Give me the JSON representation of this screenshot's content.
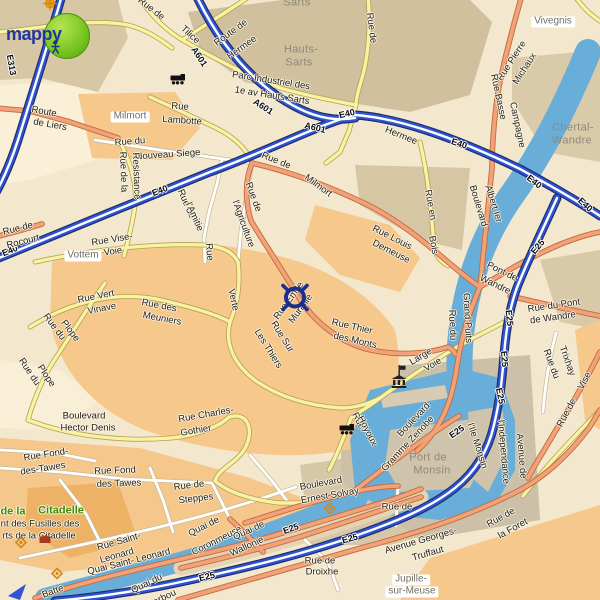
{
  "branding": {
    "logo_text": "mappy"
  },
  "marker": {
    "x": 295,
    "y": 300
  },
  "colors": {
    "water": "#68aed8",
    "highway_blue": "#2f55d4",
    "road_orange": "#f2a277",
    "road_yellow": "#f8f2a3",
    "residential_orange": "#f6c88c",
    "industrial_tan": "#d0c09e",
    "logo_green": "#76c51f",
    "logo_text_blue": "#23379b",
    "park_text_green": "#3f8c00"
  },
  "labels": [
    {
      "t": "E313",
      "x": 11,
      "y": 65,
      "r": 80,
      "c": "hwy"
    },
    {
      "t": "E40",
      "x": 10,
      "y": 251,
      "r": -22,
      "c": "hwy"
    },
    {
      "t": "E40",
      "x": 160,
      "y": 191,
      "r": -21,
      "c": "hwy"
    },
    {
      "t": "E40",
      "x": 347,
      "y": 114,
      "r": -13,
      "c": "hwy"
    },
    {
      "t": "A601",
      "x": 199,
      "y": 57,
      "r": 57,
      "c": "hwy"
    },
    {
      "t": "A601",
      "x": 263,
      "y": 107,
      "r": 33,
      "c": "hwy"
    },
    {
      "t": "A601",
      "x": 315,
      "y": 128,
      "r": 14,
      "c": "hwy"
    },
    {
      "t": "E40",
      "x": 459,
      "y": 144,
      "r": 18,
      "c": "hwy"
    },
    {
      "t": "E40",
      "x": 534,
      "y": 182,
      "r": 38,
      "c": "hwy"
    },
    {
      "t": "E40",
      "x": 585,
      "y": 205,
      "r": 43,
      "c": "hwy"
    },
    {
      "t": "E25",
      "x": 538,
      "y": 247,
      "r": -50,
      "c": "hwy"
    },
    {
      "t": "E25",
      "x": 509,
      "y": 318,
      "r": 84,
      "c": "hwy"
    },
    {
      "t": "E25",
      "x": 504,
      "y": 359,
      "r": 86,
      "c": "hwy"
    },
    {
      "t": "E25",
      "x": 500,
      "y": 396,
      "r": 78,
      "c": "hwy"
    },
    {
      "t": "E25",
      "x": 457,
      "y": 432,
      "r": -35,
      "c": "hwy"
    },
    {
      "t": "E25",
      "x": 291,
      "y": 529,
      "r": -20,
      "c": "hwy"
    },
    {
      "t": "E25",
      "x": 350,
      "y": 539,
      "r": -15,
      "c": "hwy"
    },
    {
      "t": "E25",
      "x": 207,
      "y": 577,
      "r": -13,
      "c": "hwy"
    },
    {
      "t": "Hermee",
      "x": 401,
      "y": 136,
      "r": 22,
      "c": "road"
    },
    {
      "t": "Rue de",
      "x": 151,
      "y": 9,
      "r": 38,
      "c": "road"
    },
    {
      "t": "Tilice",
      "x": 190,
      "y": 35,
      "r": 43,
      "c": "road"
    },
    {
      "t": "Route de",
      "x": 231,
      "y": 33,
      "r": -36,
      "c": "road"
    },
    {
      "t": "Hermee",
      "x": 242,
      "y": 48,
      "r": -36,
      "c": "road"
    },
    {
      "t": "Rue de",
      "x": 371,
      "y": 28,
      "r": 82,
      "c": "road"
    },
    {
      "t": "Parc Industriel des",
      "x": 271,
      "y": 81,
      "r": 9,
      "c": "road"
    },
    {
      "t": "1e av Hauts Sarts",
      "x": 272,
      "y": 96,
      "r": 9,
      "c": "road"
    },
    {
      "t": "Route",
      "x": 44,
      "y": 112,
      "r": 10,
      "c": "road"
    },
    {
      "t": "de Liers",
      "x": 50,
      "y": 125,
      "r": 10,
      "c": "road"
    },
    {
      "t": "Rue",
      "x": 180,
      "y": 107,
      "r": 4,
      "c": "road"
    },
    {
      "t": "Lambotte",
      "x": 182,
      "y": 121,
      "r": 4,
      "c": "road"
    },
    {
      "t": "Rue Pierre",
      "x": 512,
      "y": 61,
      "r": -57,
      "c": "road"
    },
    {
      "t": "Michaux",
      "x": 525,
      "y": 69,
      "r": -57,
      "c": "road"
    },
    {
      "t": "Rue Basse",
      "x": 498,
      "y": 97,
      "r": 78,
      "c": "road"
    },
    {
      "t": "Campagne",
      "x": 517,
      "y": 125,
      "r": 78,
      "c": "road"
    },
    {
      "t": "Rue du",
      "x": 130,
      "y": 142,
      "r": -4,
      "c": "road"
    },
    {
      "t": "Nouveau Siege",
      "x": 168,
      "y": 155,
      "r": -4,
      "c": "road"
    },
    {
      "t": "Rue de la",
      "x": 123,
      "y": 172,
      "r": 88,
      "c": "road"
    },
    {
      "t": "Resistance",
      "x": 136,
      "y": 176,
      "r": 88,
      "c": "road"
    },
    {
      "t": "Rue de",
      "x": 18,
      "y": 229,
      "r": -14,
      "c": "road"
    },
    {
      "t": "Rocourt",
      "x": 23,
      "y": 242,
      "r": -14,
      "c": "road"
    },
    {
      "t": "Rue Vise-",
      "x": 112,
      "y": 240,
      "r": -9,
      "c": "road"
    },
    {
      "t": "Voie",
      "x": 113,
      "y": 252,
      "r": -9,
      "c": "road"
    },
    {
      "t": "Rue de",
      "x": 186,
      "y": 204,
      "r": 66,
      "c": "road"
    },
    {
      "t": "l'Amitie",
      "x": 194,
      "y": 217,
      "r": 66,
      "c": "road"
    },
    {
      "t": "Rue de",
      "x": 253,
      "y": 197,
      "r": 70,
      "c": "road"
    },
    {
      "t": "l'Agriculture",
      "x": 243,
      "y": 224,
      "r": 70,
      "c": "road"
    },
    {
      "t": "Rue de",
      "x": 276,
      "y": 161,
      "r": 22,
      "c": "road"
    },
    {
      "t": "Milmort",
      "x": 318,
      "y": 186,
      "r": 36,
      "c": "road"
    },
    {
      "t": "Rue Louis",
      "x": 392,
      "y": 238,
      "r": 27,
      "c": "road"
    },
    {
      "t": "Demeuse",
      "x": 391,
      "y": 252,
      "r": 27,
      "c": "road"
    },
    {
      "t": "Rue en",
      "x": 430,
      "y": 205,
      "r": 80,
      "c": "road"
    },
    {
      "t": "Bois",
      "x": 433,
      "y": 245,
      "r": 80,
      "c": "road"
    },
    {
      "t": "Boulevard",
      "x": 478,
      "y": 206,
      "r": 73,
      "c": "road"
    },
    {
      "t": "Albert Ier",
      "x": 493,
      "y": 204,
      "r": 73,
      "c": "road"
    },
    {
      "t": "Pont de",
      "x": 502,
      "y": 272,
      "r": 26,
      "c": "road"
    },
    {
      "t": "Wandre",
      "x": 495,
      "y": 285,
      "r": 26,
      "c": "road"
    },
    {
      "t": "Rue du",
      "x": 452,
      "y": 325,
      "r": 87,
      "c": "road"
    },
    {
      "t": "Grand Puits",
      "x": 467,
      "y": 318,
      "r": 87,
      "c": "road"
    },
    {
      "t": "Rue du Pont",
      "x": 554,
      "y": 306,
      "r": -8,
      "c": "road"
    },
    {
      "t": "de Wandre",
      "x": 553,
      "y": 318,
      "r": -8,
      "c": "road"
    },
    {
      "t": "Rue du",
      "x": 551,
      "y": 364,
      "r": 70,
      "c": "road"
    },
    {
      "t": "Trixhay",
      "x": 567,
      "y": 361,
      "r": 70,
      "c": "road"
    },
    {
      "t": "Rue de",
      "x": 567,
      "y": 413,
      "r": -62,
      "c": "road"
    },
    {
      "t": "Vise",
      "x": 585,
      "y": 381,
      "r": -62,
      "c": "road"
    },
    {
      "t": "Rue Vert",
      "x": 96,
      "y": 297,
      "r": -11,
      "c": "road"
    },
    {
      "t": "Vinave",
      "x": 102,
      "y": 309,
      "r": -11,
      "c": "road"
    },
    {
      "t": "Rue des",
      "x": 159,
      "y": 306,
      "r": 11,
      "c": "road"
    },
    {
      "t": "Meuniers",
      "x": 162,
      "y": 319,
      "r": 11,
      "c": "road"
    },
    {
      "t": "Rue du",
      "x": 54,
      "y": 327,
      "r": 53,
      "c": "road"
    },
    {
      "t": "Plope",
      "x": 70,
      "y": 331,
      "r": 53,
      "c": "road"
    },
    {
      "t": "Rue du",
      "x": 29,
      "y": 372,
      "r": 56,
      "c": "road"
    },
    {
      "t": "Plope",
      "x": 46,
      "y": 376,
      "r": 56,
      "c": "road"
    },
    {
      "t": "Verte",
      "x": 233,
      "y": 300,
      "r": 78,
      "c": "road"
    },
    {
      "t": "Rue",
      "x": 209,
      "y": 252,
      "r": 85,
      "c": "road"
    },
    {
      "t": "Rue Sur",
      "x": 282,
      "y": 337,
      "r": 58,
      "c": "road"
    },
    {
      "t": "Les Thiers",
      "x": 268,
      "y": 349,
      "r": 58,
      "c": "road"
    },
    {
      "t": "Rue Emile",
      "x": 289,
      "y": 301,
      "r": -54,
      "c": "road"
    },
    {
      "t": "Muraille",
      "x": 301,
      "y": 309,
      "r": -54,
      "c": "road"
    },
    {
      "t": "Rue Thier",
      "x": 352,
      "y": 327,
      "r": 13,
      "c": "road"
    },
    {
      "t": "des Monts",
      "x": 355,
      "y": 341,
      "r": 13,
      "c": "road"
    },
    {
      "t": "Large",
      "x": 421,
      "y": 357,
      "r": -31,
      "c": "road"
    },
    {
      "t": "Voie",
      "x": 433,
      "y": 365,
      "r": -31,
      "c": "road"
    },
    {
      "t": "Boulevard",
      "x": 84,
      "y": 416,
      "r": 0,
      "c": "road"
    },
    {
      "t": "Hector Denis",
      "x": 88,
      "y": 428,
      "r": 0,
      "c": "road"
    },
    {
      "t": "Rue Charles-",
      "x": 206,
      "y": 415,
      "r": -10,
      "c": "road"
    },
    {
      "t": "Gothier",
      "x": 196,
      "y": 431,
      "r": -10,
      "c": "road"
    },
    {
      "t": "Rue Fond-",
      "x": 46,
      "y": 455,
      "r": -9,
      "c": "road"
    },
    {
      "t": "des-Tawes",
      "x": 43,
      "y": 469,
      "r": -9,
      "c": "road"
    },
    {
      "t": "Rue Fond",
      "x": 115,
      "y": 471,
      "r": -2,
      "c": "road"
    },
    {
      "t": "des Tawes",
      "x": 119,
      "y": 484,
      "r": -2,
      "c": "road"
    },
    {
      "t": "Rue de",
      "x": 189,
      "y": 486,
      "r": -7,
      "c": "road"
    },
    {
      "t": "Steppes",
      "x": 196,
      "y": 499,
      "r": -7,
      "c": "road"
    },
    {
      "t": "Rue Saint-",
      "x": 119,
      "y": 542,
      "r": -16,
      "c": "road"
    },
    {
      "t": "Leonard",
      "x": 117,
      "y": 556,
      "r": -16,
      "c": "road"
    },
    {
      "t": "Quai de",
      "x": 204,
      "y": 527,
      "r": -27,
      "c": "road"
    },
    {
      "t": "Coronmeuse",
      "x": 217,
      "y": 541,
      "r": -27,
      "c": "road"
    },
    {
      "t": "Quai de",
      "x": 249,
      "y": 531,
      "r": -25,
      "c": "road"
    },
    {
      "t": "Wallonie",
      "x": 247,
      "y": 547,
      "r": -25,
      "c": "road"
    },
    {
      "t": "Quai Saint- Leonard",
      "x": 129,
      "y": 562,
      "r": -14,
      "c": "road"
    },
    {
      "t": "Quai du",
      "x": 147,
      "y": 584,
      "r": -26,
      "c": "road"
    },
    {
      "t": "Barbou",
      "x": 162,
      "y": 599,
      "r": -26,
      "c": "road"
    },
    {
      "t": "Batte",
      "x": 53,
      "y": 592,
      "r": -20,
      "c": "road"
    },
    {
      "t": "Boulevard",
      "x": 321,
      "y": 484,
      "r": -10,
      "c": "road"
    },
    {
      "t": "Ernest Solvay",
      "x": 330,
      "y": 496,
      "r": -10,
      "c": "road"
    },
    {
      "t": "Rue de",
      "x": 397,
      "y": 507,
      "r": 0,
      "c": "road"
    },
    {
      "t": "Avenue Georges-",
      "x": 421,
      "y": 541,
      "r": -16,
      "c": "road"
    },
    {
      "t": "Truffaut",
      "x": 428,
      "y": 554,
      "r": -16,
      "c": "road"
    },
    {
      "t": "Rue de",
      "x": 501,
      "y": 518,
      "r": -29,
      "c": "road"
    },
    {
      "t": "la Foret",
      "x": 513,
      "y": 529,
      "r": -29,
      "c": "road"
    },
    {
      "t": "Rue de",
      "x": 320,
      "y": 561,
      "r": 0,
      "c": "road"
    },
    {
      "t": "Droixhe",
      "x": 322,
      "y": 572,
      "r": 0,
      "c": "road"
    },
    {
      "t": "Boulevard",
      "x": 414,
      "y": 420,
      "r": -47,
      "c": "road"
    },
    {
      "t": "Gramme Zenobe",
      "x": 408,
      "y": 444,
      "r": -47,
      "c": "road"
    },
    {
      "t": "Rue",
      "x": 358,
      "y": 421,
      "r": 63,
      "c": "road"
    },
    {
      "t": "Hoyoux",
      "x": 367,
      "y": 431,
      "r": 63,
      "c": "road"
    },
    {
      "t": "Avenue de",
      "x": 521,
      "y": 456,
      "r": 85,
      "c": "road"
    },
    {
      "t": "l'Independance",
      "x": 503,
      "y": 452,
      "r": 85,
      "c": "road"
    },
    {
      "t": "l'Ile Monsin",
      "x": 477,
      "y": 446,
      "r": 72,
      "c": "road"
    },
    {
      "t": "nt des Fusilles des",
      "x": 40,
      "y": 524,
      "r": 0,
      "c": "road"
    },
    {
      "t": "rts de la Citadelle",
      "x": 39,
      "y": 536,
      "r": 0,
      "c": "road"
    },
    {
      "t": "Sarts",
      "x": 297,
      "y": 3,
      "r": 0,
      "c": "area"
    },
    {
      "t": "Hauts-",
      "x": 301,
      "y": 50,
      "r": 0,
      "c": "area"
    },
    {
      "t": "Sarts",
      "x": 299,
      "y": 63,
      "r": 0,
      "c": "area"
    },
    {
      "t": "Chertal-",
      "x": 573,
      "y": 128,
      "r": 0,
      "c": "area"
    },
    {
      "t": "Wandre",
      "x": 572,
      "y": 141,
      "r": 0,
      "c": "area"
    },
    {
      "t": "Port de",
      "x": 428,
      "y": 458,
      "r": 0,
      "c": "area"
    },
    {
      "t": "Monsin",
      "x": 432,
      "y": 471,
      "r": 0,
      "c": "area"
    },
    {
      "t": "Milmort",
      "x": 130,
      "y": 117,
      "r": 0,
      "c": "loc"
    },
    {
      "t": "Vivegnis",
      "x": 553,
      "y": 22,
      "r": 0,
      "c": "loc"
    },
    {
      "t": "Vottem",
      "x": 83,
      "y": 256,
      "r": 0,
      "c": "loc"
    },
    {
      "t": "Jupille-",
      "x": 411,
      "y": 580,
      "r": 0,
      "c": "loc"
    },
    {
      "t": "sur-Meuse",
      "x": 412,
      "y": 592,
      "r": 0,
      "c": "loc"
    },
    {
      "t": "de la",
      "x": 13,
      "y": 512,
      "r": 0,
      "c": "park"
    },
    {
      "t": "Citadelle",
      "x": 61,
      "y": 511,
      "r": 0,
      "c": "park"
    }
  ],
  "icons": [
    {
      "n": "compass-rose",
      "x": 50,
      "y": 6
    },
    {
      "n": "train-station",
      "x": 178,
      "y": 81
    },
    {
      "n": "train-station",
      "x": 347,
      "y": 431
    },
    {
      "n": "monument",
      "x": 399,
      "y": 384
    },
    {
      "n": "flag",
      "x": 402,
      "y": 372
    },
    {
      "n": "poi-diamond",
      "x": 21,
      "y": 545
    },
    {
      "n": "poi-diamond",
      "x": 57,
      "y": 576
    },
    {
      "n": "poi-diamond",
      "x": 330,
      "y": 511
    },
    {
      "n": "fort",
      "x": 45,
      "y": 540
    }
  ]
}
